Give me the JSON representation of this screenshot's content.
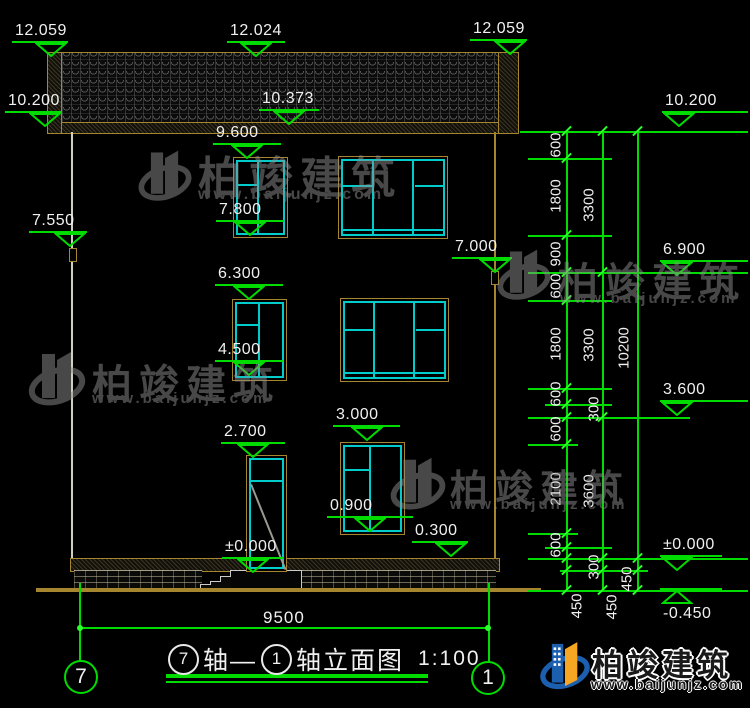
{
  "title": {
    "axis_left": "7",
    "segment1": "轴—",
    "axis_right": "1",
    "segment2": "轴立面图",
    "scale": "1:100"
  },
  "axes": {
    "left": "7",
    "right": "1"
  },
  "markers": {
    "roof_left": "12.059",
    "roof_mid": "12.024",
    "roof_right": "12.059",
    "eave_left": "10.200",
    "eave_mid": "10.373",
    "eave_right": "10.200",
    "w3_top": "9.600",
    "w3_bottom": "7.800",
    "left_wall": "7.550",
    "right_wall": "7.000",
    "r_6900": "6.900",
    "w2_top": "6.300",
    "w2_bottom": "4.500",
    "r_3600": "3.600",
    "door_top": "2.700",
    "w1_top": "3.000",
    "w1_bottom": "0.900",
    "plinth": "0.300",
    "zero_door": "±0.000",
    "zero_right": "±0.000",
    "neg_ground": "-0.450"
  },
  "dims": {
    "colA": [
      "600",
      "1800",
      "900",
      "600",
      "1800",
      "600",
      "300",
      "600",
      "2100",
      "600",
      "300",
      "450"
    ],
    "colB": [
      "3300",
      "3300",
      "3600",
      "450"
    ],
    "colC": [
      "10200",
      "450"
    ],
    "bottom_width": "9500"
  },
  "watermark": {
    "name": "柏竣建筑",
    "url": "www.baijunjz.com"
  },
  "logo": {
    "name": "柏竣建筑",
    "url": "www.baijunjz.com"
  },
  "colors": {
    "line_green": "#00dc00",
    "cad_cyan": "#00cccc",
    "cad_tan": "#a5862e",
    "text": "#f0f0f0"
  }
}
